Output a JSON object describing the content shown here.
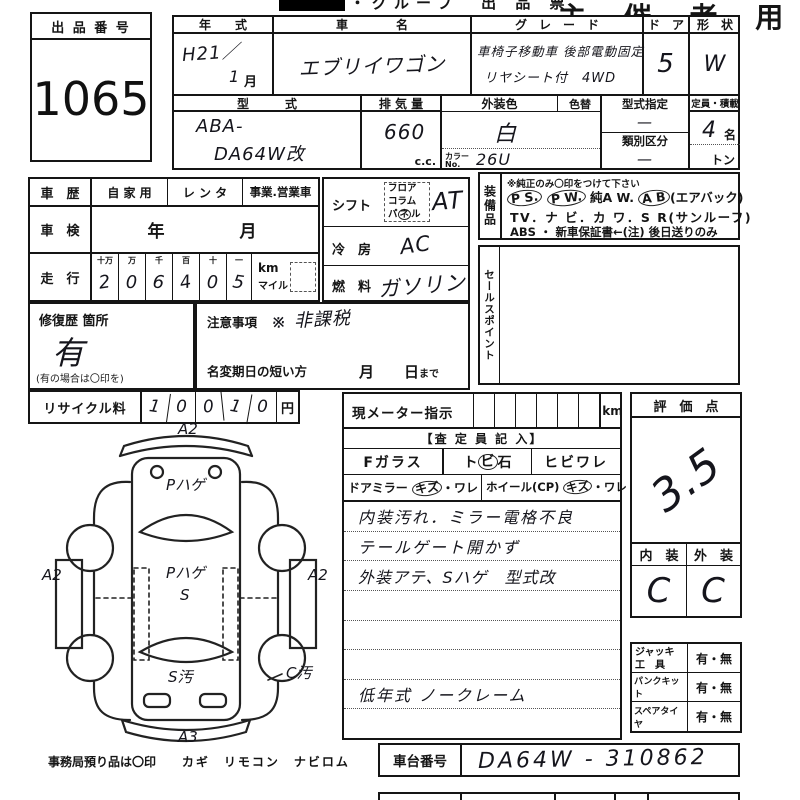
{
  "header": {
    "strip_title": "・グループ　出 品 票",
    "organizer": "主 催 者 用"
  },
  "lot": {
    "label": "出 品 番 号",
    "number": "1065"
  },
  "top": {
    "year": {
      "h": "年　　式",
      "v1": "H21／",
      "v2": "1",
      "month": "月"
    },
    "name": {
      "h": "車　　　　名",
      "v": "エブリイワゴン"
    },
    "grade": {
      "h": "グ　レ　ー　ド",
      "v1": "車椅子移動車 後部電動固定",
      "v2": "リヤシート付　4WD"
    },
    "door": {
      "h": "ド　ア",
      "v": "5"
    },
    "shape": {
      "h": "形　状",
      "v": "W"
    },
    "model": {
      "h": "型　　　式",
      "v1": "ABA-",
      "v2": "DA64W改"
    },
    "disp": {
      "h": "排 気 量",
      "v": "660",
      "unit": "c.c."
    },
    "color": {
      "h": "外装色",
      "h2": "色替",
      "v": "白",
      "no_label": "カラー",
      "no_label2": "No.",
      "no": "26U"
    },
    "tdes": {
      "h": "型式指定",
      "v": "—",
      "h2": "類別区分",
      "v2": "—"
    },
    "cap": {
      "h": "定員・積載",
      "v": "4",
      "u1": "名",
      "u2": "トン"
    }
  },
  "left": {
    "history": {
      "h": "車　歴",
      "o1": "自 家 用",
      "o2": "レ ン タ",
      "o3": "事業.営業車"
    },
    "syaken": {
      "h": "車　検",
      "v": "年　　　月"
    },
    "mileage": {
      "h": "走　行",
      "labels": [
        "十万",
        "万",
        "千",
        "百",
        "十",
        "一"
      ],
      "digits": [
        "2",
        "0",
        "6",
        "4",
        "0",
        "5"
      ],
      "u1": "km",
      "u2": "マイル"
    },
    "repair": {
      "h": "修復歴 箇所",
      "v": "有",
      "note": "(有の場合は〇印を)"
    },
    "caution": {
      "h": "注意事項",
      "v": "※ 非課税",
      "h2": "名変期日の短い方",
      "v2": "月　　日",
      "v2b": "まで"
    }
  },
  "mid": {
    "shift": {
      "h": "シフト",
      "p1": "フロア",
      "p2": "コラム",
      "p3a": "パ",
      "p3b": "ネ",
      "p3c": "ル",
      "v": "AT"
    },
    "ac": {
      "h": "冷　房",
      "v": "AC"
    },
    "fuel": {
      "h": "燃　料",
      "v": "ガソリン"
    }
  },
  "equip": {
    "h": "装備品",
    "note": "※純正のみ〇印をつけて下さい",
    "l1a": "P S.",
    "l1b": "P W.",
    "l1c": "純A W.",
    "l1d": "A B",
    "l1e": "(エアバック)",
    "l2": "TV．ナ ビ．カ ワ．S R(サンルーフ)",
    "l3": "ABS ・ 新車保証書←(注) 後日送りのみ"
  },
  "sales": {
    "h": "セールスポイント"
  },
  "recycle": {
    "h": "リサイクル料",
    "digits": [
      "1",
      "0",
      "0",
      "1",
      "0"
    ],
    "unit": "円"
  },
  "meter": {
    "h": "現メーター指示",
    "unit": "km"
  },
  "assess": {
    "h": "【査 定 員 記 入】",
    "fglass": "Fガラス",
    "tobi_a": "ト",
    "tobi_b": "ビ",
    "tobi_c": "石",
    "hibi": "ヒビワレ",
    "mirror": "ドアミラー",
    "kizu": "キズ",
    "ware": "・ワレ",
    "wheel": "ホイール(CP)",
    "notes": [
      "内装汚れ．ミラー電格不良",
      "テールゲート開かず",
      "外装アテ、Sハゲ　型式改",
      "",
      "",
      "",
      "低年式 ノークレーム",
      ""
    ]
  },
  "rating": {
    "h": "評　価　点",
    "v": "3.5",
    "in_h": "内　装",
    "out_h": "外　装",
    "in_v": "C",
    "out_v": "C"
  },
  "tools": {
    "r1h": "ジャッキ",
    "r1h2": "工　具",
    "r1v": "有・無",
    "r2h": "パンクキット",
    "r2v": "有・無",
    "r3h": "スペアタイヤ",
    "r3v": "有・無"
  },
  "chassis": {
    "h": "車台番号",
    "v": "DA64W - 310862"
  },
  "office": {
    "t1": "事務局預り品は〇印",
    "t2": "カギ　リモコン　ナビロム"
  },
  "diagram": {
    "top": "A2",
    "hood": "Pハゲ",
    "left": "A2",
    "center1": "Pハゲ",
    "center2": "S",
    "right": "A2",
    "rear": "S汚",
    "side": "C汚",
    "bottom": "A3"
  }
}
